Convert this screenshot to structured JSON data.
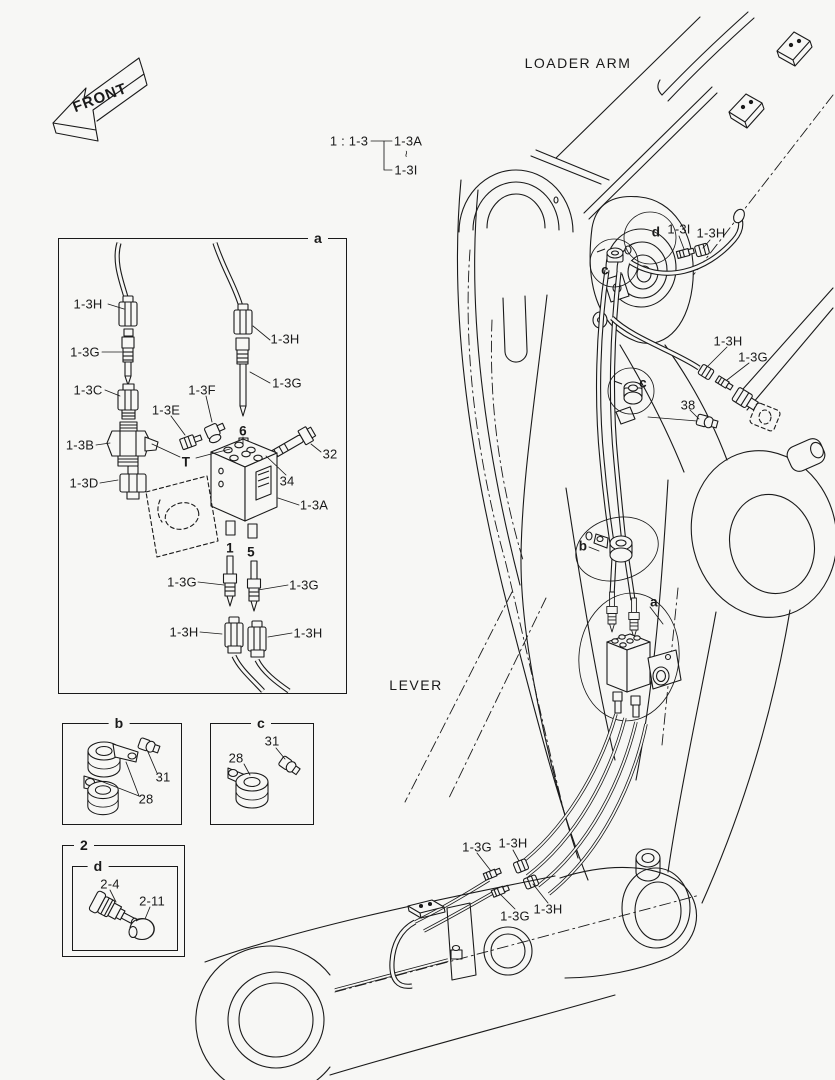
{
  "page": {
    "background": "#f7f7f5",
    "ink": "#1a1a1a"
  },
  "front_marker": {
    "label": "FRONT"
  },
  "reference_note": {
    "assembly": "1 : 1-3",
    "range_first": "1-3A",
    "range_tilde": "~",
    "range_last": "1-3I"
  },
  "captions": {
    "loader_arm": "LOADER ARM",
    "lever": "LEVER"
  },
  "boxes": {
    "a_tag": "a",
    "b_tag": "b",
    "c_tag": "c",
    "outer_tag": "2",
    "inner_tag": "d"
  },
  "detail_a_parts": {
    "p0": "1-3H",
    "p1": "1-3G",
    "p2": "1-3C",
    "p3": "1-3E",
    "p4": "1-3F",
    "p5": "1-3B",
    "p6": "1-3D",
    "p7": "T",
    "p8": "1-3H",
    "p9": "1-3G",
    "p10": "6",
    "p11": "32",
    "p12": "34",
    "p13": "1-3A",
    "p14": "1",
    "p15": "5",
    "p16": "1-3G",
    "p17": "1-3G",
    "p18": "1-3H",
    "p19": "1-3H"
  },
  "detail_b_parts": {
    "bolt": "31",
    "clamp": "28"
  },
  "detail_c_parts": {
    "bolt": "31",
    "clamp": "28"
  },
  "detail_2_parts": {
    "fitting": "2-4",
    "cap": "2-11"
  },
  "main_parts": {
    "callout_d": "d",
    "p_1_3i": "1-3I",
    "p_1_3h_top": "1-3H",
    "callout_c_top": "c",
    "p_1_3h_mid": "1-3H",
    "p_1_3g_mid": "1-3G",
    "callout_c_mid": "c",
    "p_38": "38",
    "callout_b": "b",
    "callout_a": "a",
    "p_1_3g_bl": "1-3G",
    "p_1_3h_bl": "1-3H",
    "p_1_3g_bb": "1-3G",
    "p_1_3h_bb": "1-3H"
  }
}
